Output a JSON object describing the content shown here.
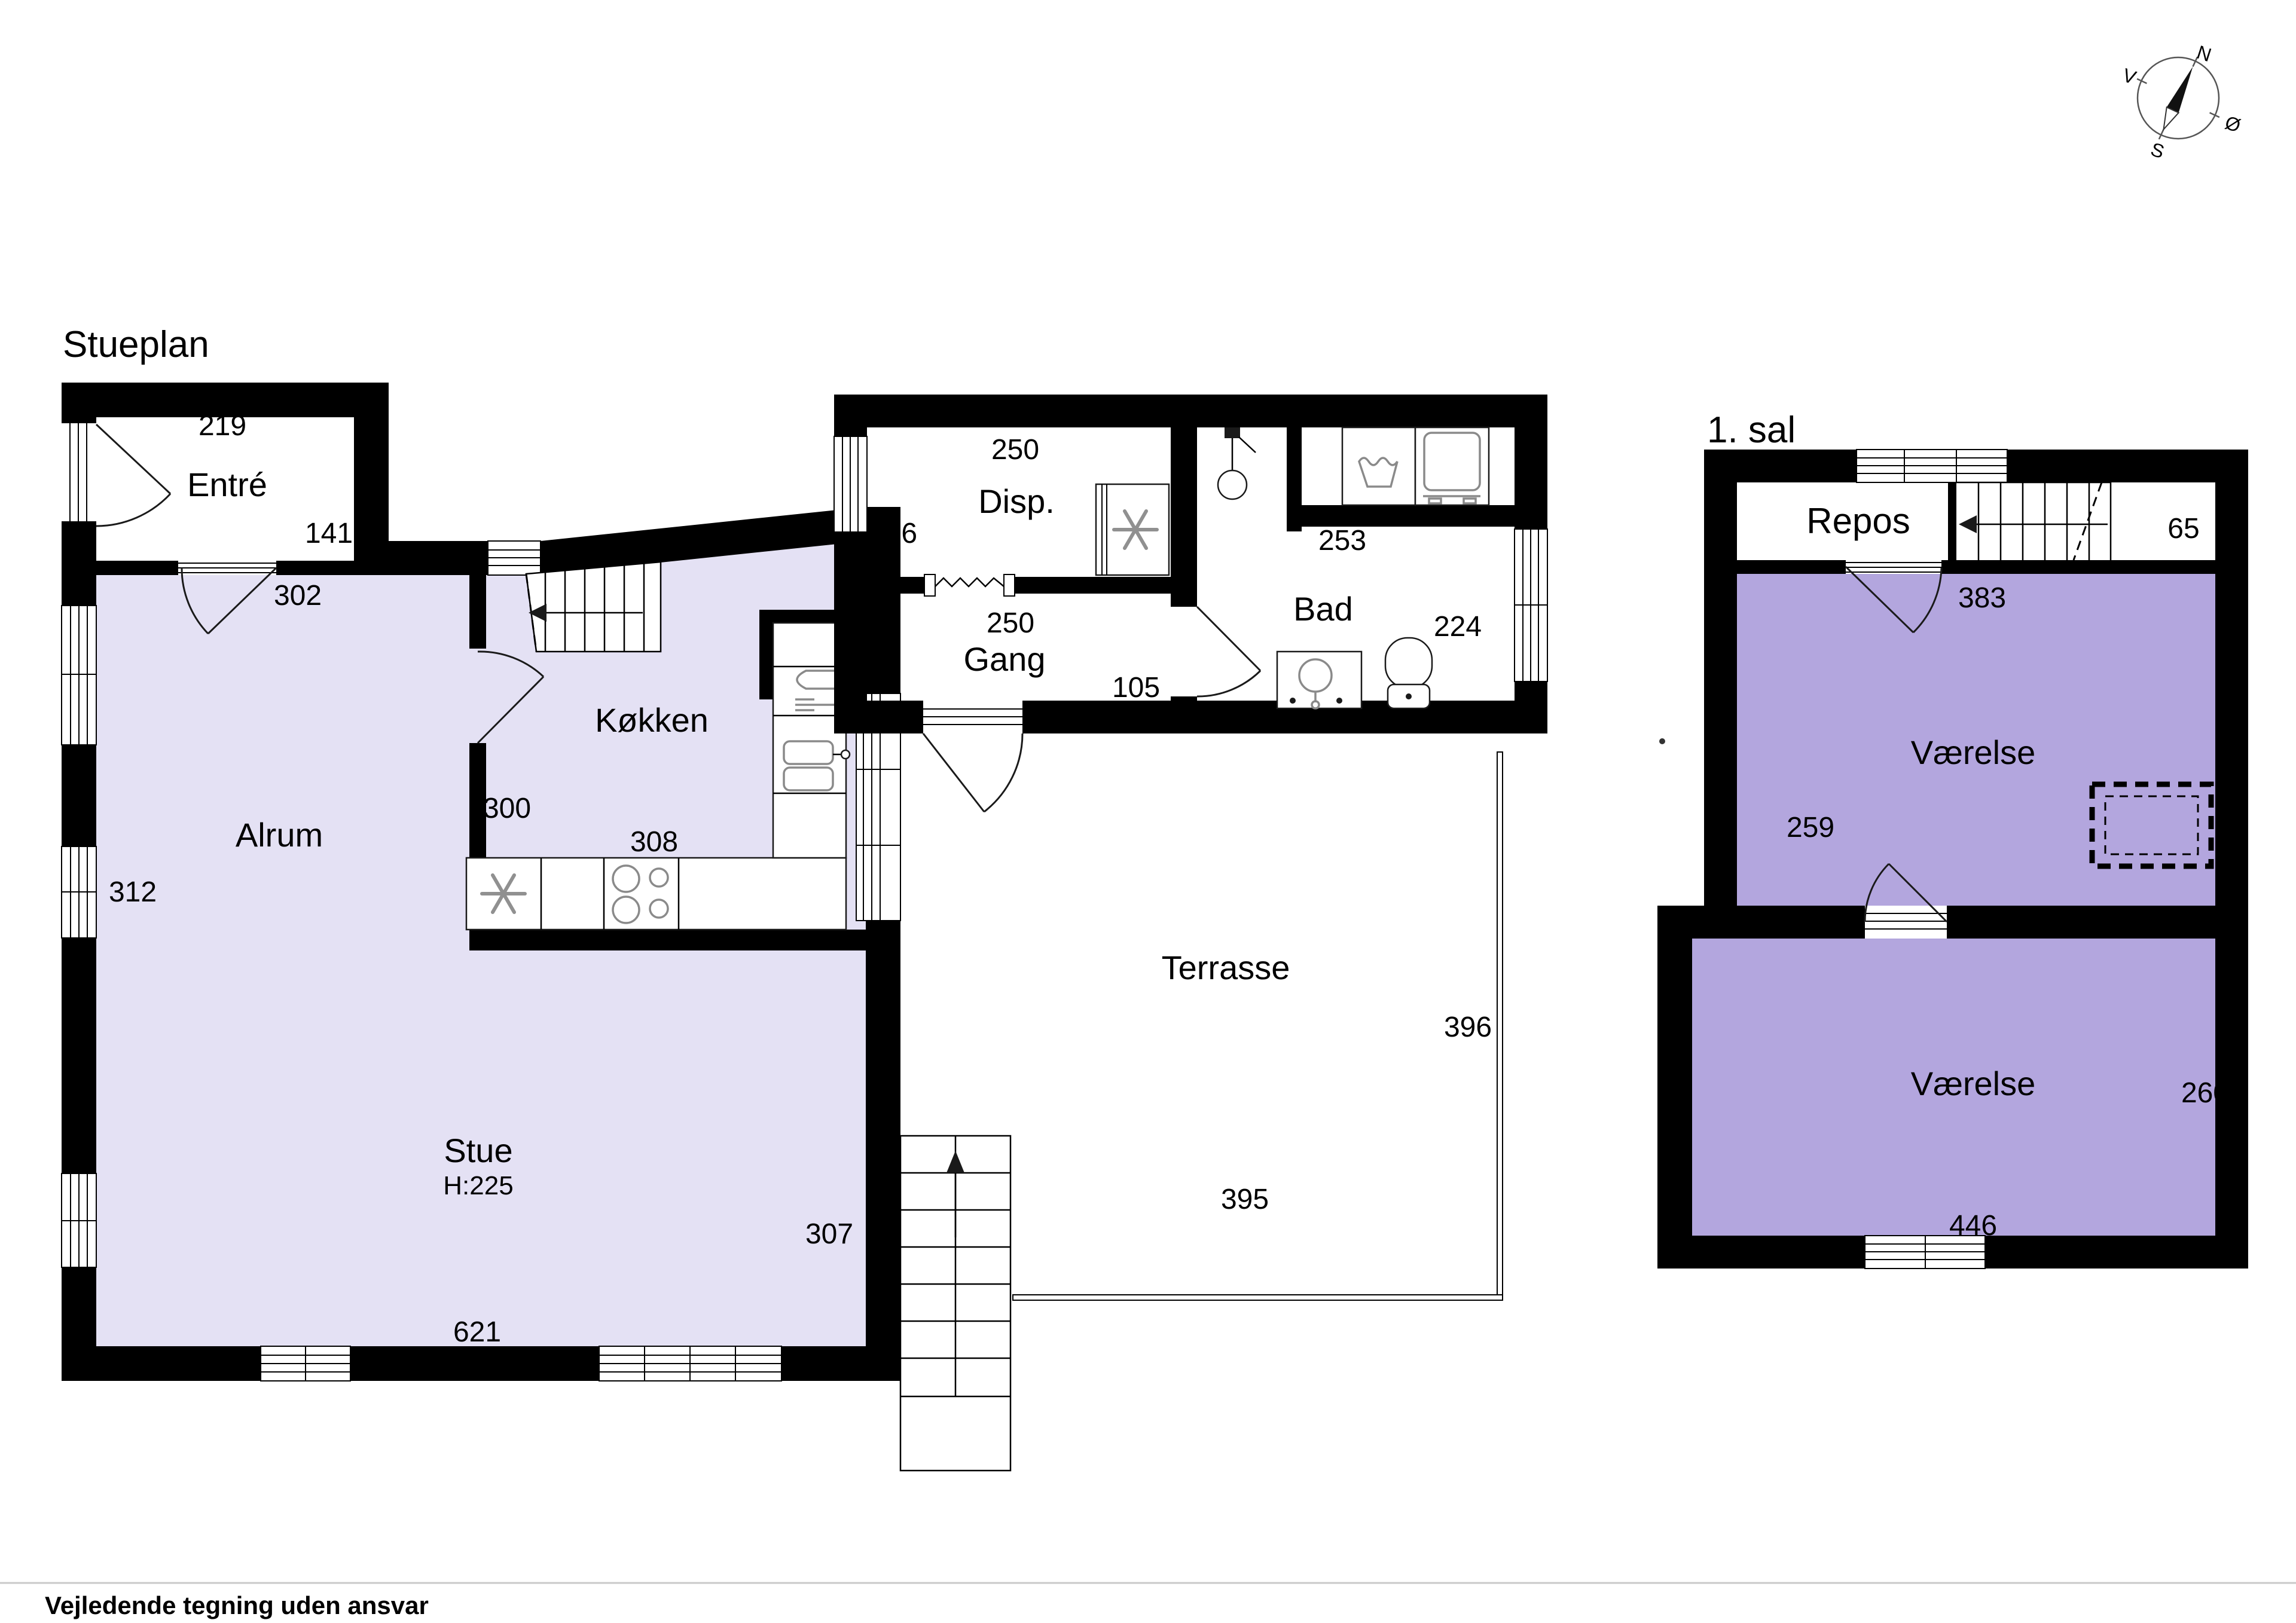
{
  "colors": {
    "wall": "#000000",
    "ground_floor_fill": "#e4e1f4",
    "first_floor_fill": "#b3a6de",
    "fixture_icon": "#8a8a8a"
  },
  "footer": {
    "disclaimer": "Vejledende tegning uden ansvar"
  },
  "compass": {
    "north": "N",
    "east": "Ø",
    "south": "S",
    "west": "V"
  },
  "stueplan": {
    "title": "Stueplan",
    "entre": {
      "label": "Entré",
      "dim_width": "219",
      "dim_height": "141"
    },
    "alrum": {
      "label": "Alrum",
      "dim_height": "312",
      "entry_dim": "302"
    },
    "kokken": {
      "label": "Køkken",
      "dim_height": "300",
      "dim_width": "308"
    },
    "stue": {
      "label": "Stue",
      "ceiling": "H:225",
      "dim_width": "621",
      "dim_height": "307"
    },
    "disp": {
      "label": "Disp.",
      "dim_width": "250",
      "dim_height": "106"
    },
    "gang": {
      "label": "Gang",
      "dim_width": "250",
      "dim_door": "105"
    },
    "bad": {
      "label": "Bad",
      "dim_width": "253",
      "dim_height": "224"
    },
    "terrasse": {
      "label": "Terrasse",
      "dim_height": "396",
      "dim_width": "395"
    }
  },
  "first_floor": {
    "title": "1. sal",
    "repos": {
      "label": "Repos",
      "stair_dim": "65",
      "door_dim": "383"
    },
    "room_upper": {
      "label": "Værelse",
      "dim_height": "259"
    },
    "room_lower": {
      "label": "Værelse",
      "dim_height": "260",
      "dim_width": "446"
    }
  }
}
